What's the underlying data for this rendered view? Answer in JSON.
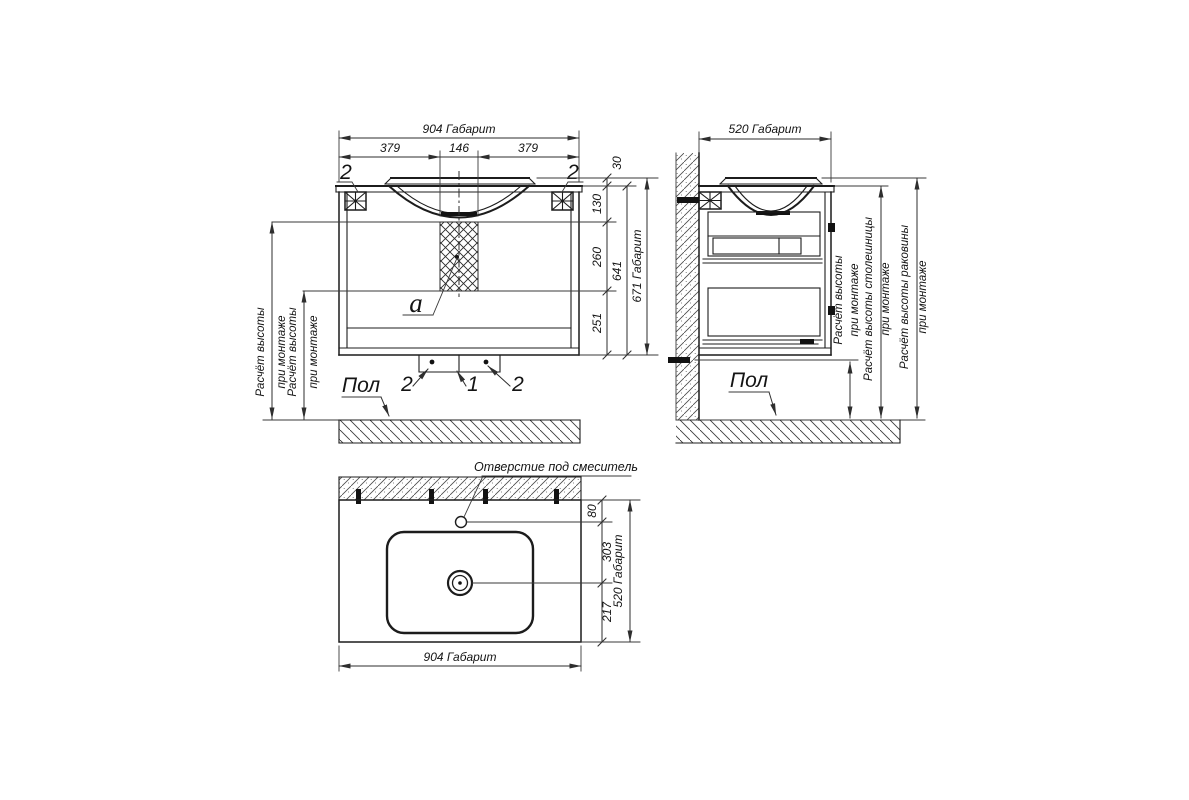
{
  "front_view": {
    "dims": {
      "overall_width": "904 Габарит",
      "left": "379",
      "center": "146",
      "right": "379",
      "rim": "30",
      "upper": "130",
      "middle": "260",
      "lower": "251",
      "body": "641",
      "overall_height": "671 Габарит"
    },
    "callouts": {
      "bracket_left": "2",
      "bracket_right": "2",
      "siphon": "a",
      "foot_left": "2",
      "drain": "1",
      "foot_right": "2"
    },
    "floor_label": "Пол",
    "install_height_1": {
      "line1": "Расчёт высоты",
      "line2": "при монтаже"
    },
    "install_height_2": {
      "line1": "Расчёт высоты",
      "line2": "при монтаже"
    }
  },
  "side_view": {
    "dims": {
      "overall_depth": "520 Габарит"
    },
    "floor_label": "Пол",
    "install_height": {
      "line1": "Расчёт высоты",
      "line2": "при монтаже"
    },
    "countertop_height": {
      "line1": "Расчёт высоты столешницы",
      "line2": "при монтаже"
    },
    "sink_height": {
      "line1": "Расчёт высоты раковины",
      "line2": "при монтаже"
    }
  },
  "plan_view": {
    "faucet_hole_label": "Отверстие под смеситель",
    "dims": {
      "hole_offset": "80",
      "hole_to_drain": "303",
      "drain_to_edge": "217",
      "overall_depth": "520 Габарит",
      "overall_width": "904 Габарит"
    }
  }
}
